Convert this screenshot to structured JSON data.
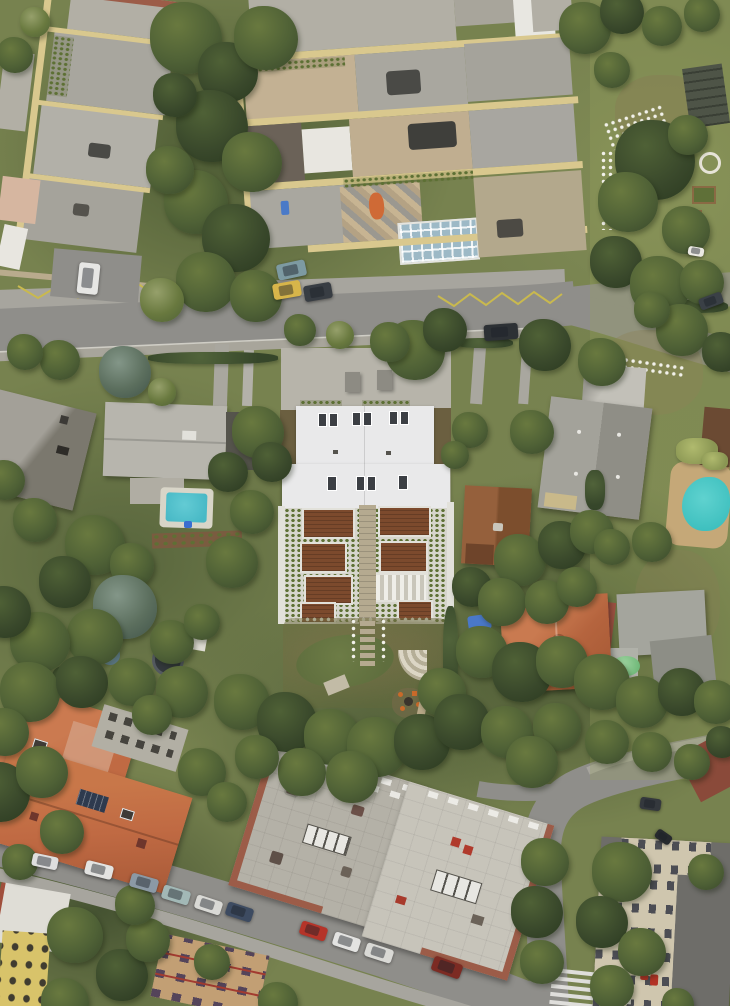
{
  "meta": {
    "type": "aerial-drone-photograph",
    "description": "Top-down drone photo of a residential neighborhood: a central white-standing-seam-roof terraced building with brown wooden deck terraces and a landscaped garden with oval lawn, surrounded by apartment blocks with roof terraces (top), family houses with pools (left and right), orange tiled roofs and flat-roofed apartment blocks (bottom), streets with parked cars, and dense trees."
  },
  "palette": {
    "grass": "#77824f",
    "grassDark": "#55633a",
    "grassLight": "#8d9663",
    "treeDark": "#39482b",
    "treeMid": "#4f6136",
    "treeLight": "#69793f",
    "treeBlue": "#5c6f5e",
    "asphalt": "#8f8e8a",
    "asphaltLight": "#a7a59e",
    "sidewalk": "#b0aea6",
    "yellowLine": "#c9b94e",
    "wallTan": "#b9ab8d",
    "whiteRoof": "#e9e9ea",
    "deckBrown": "#7c4a2d",
    "frameWhite": "#e2e1da",
    "stairBeige": "#b5aa90",
    "lawn": "#5f6e3e",
    "gardenSoil": "#75714b",
    "poolBlue": "#48b9c6",
    "poolRound": "#3fc0bf",
    "sandDeck": "#c5a878",
    "orangeRoof": "#c06a43",
    "orangeWorn": "#d29a7c",
    "tileRed": "#a04f3c",
    "greyRoof": "#b2afa5",
    "greyRoofDark": "#98968c",
    "metalRoof": "#b7b5ad",
    "cream": "#d9c88e",
    "yellowWall": "#d8c36a",
    "redBrick": "#9c5c48",
    "blockA": "#b4b1a7",
    "blockB": "#c7c4ba",
    "beigeWall": "#cfc6ae",
    "tanFacade": "#c29f74",
    "darkRoof": "#6e6d69",
    "cabinRust": "#8a5535",
    "ruinDark": "#4e5447",
    "conservGlass": "#9db9c6",
    "solarDark": "#2e3a4e",
    "orangeTent": "#cf6a36",
    "firePit": "#c96a2a"
  },
  "scene": {
    "landmarks": [
      "white-roof-terraced-building-center",
      "roof-terrace-apartments-top",
      "community-garden-right",
      "rectangular-pool-left-garden",
      "round-pool-right-garden",
      "rust-cabin",
      "orange-tile-roof-complex-bottom-left",
      "flat-roof-apartment-blocks-bottom-center",
      "beige-office-building-bottom-right",
      "oval-lawn-with-stepping-path",
      "fire-pit-with-orange-stools"
    ],
    "cars": [
      [
        78,
        263,
        21,
        31,
        6,
        "#e6e6e4"
      ],
      [
        277,
        262,
        29,
        16,
        -12,
        "#7d9aa2"
      ],
      [
        273,
        282,
        28,
        16,
        -10,
        "#d7b54a"
      ],
      [
        304,
        284,
        28,
        16,
        -10,
        "#383d43"
      ],
      [
        484,
        324,
        34,
        16,
        -4,
        "#2d3135"
      ],
      [
        699,
        295,
        24,
        12,
        -20,
        "#3a4046"
      ],
      [
        640,
        798,
        21,
        12,
        8,
        "#34383d"
      ],
      [
        655,
        832,
        17,
        10,
        35,
        "#26292d"
      ],
      [
        32,
        855,
        26,
        13,
        12,
        "#dedede"
      ],
      [
        85,
        863,
        28,
        14,
        14,
        "#e3e3e1"
      ],
      [
        130,
        876,
        28,
        14,
        16,
        "#8b99a5"
      ],
      [
        162,
        888,
        28,
        14,
        17,
        "#a2b8b6"
      ],
      [
        195,
        898,
        27,
        14,
        18,
        "#d9d9d5"
      ],
      [
        226,
        905,
        27,
        14,
        18,
        "#3d4b61"
      ],
      [
        300,
        924,
        27,
        14,
        18,
        "#b53429"
      ],
      [
        333,
        935,
        27,
        14,
        18,
        "#e3e3e1"
      ],
      [
        365,
        946,
        28,
        14,
        18,
        "#d9d9d5"
      ],
      [
        432,
        960,
        30,
        15,
        20,
        "#7c2b23"
      ],
      [
        688,
        247,
        16,
        9,
        10,
        "#ebe9e3"
      ]
    ],
    "trees": [
      [
        15,
        55,
        18,
        0
      ],
      [
        35,
        22,
        15,
        2
      ],
      [
        186,
        38,
        36,
        0
      ],
      [
        228,
        72,
        30,
        1
      ],
      [
        266,
        38,
        32,
        0
      ],
      [
        212,
        126,
        36,
        1
      ],
      [
        252,
        162,
        30,
        0
      ],
      [
        196,
        202,
        32,
        0
      ],
      [
        236,
        238,
        34,
        1
      ],
      [
        206,
        282,
        30,
        0
      ],
      [
        256,
        296,
        26,
        0
      ],
      [
        162,
        300,
        22,
        2
      ],
      [
        170,
        170,
        24,
        0
      ],
      [
        175,
        95,
        22,
        1
      ],
      [
        585,
        28,
        26,
        0
      ],
      [
        622,
        12,
        22,
        1
      ],
      [
        662,
        26,
        20,
        0
      ],
      [
        702,
        14,
        18,
        0
      ],
      [
        612,
        70,
        18,
        0
      ],
      [
        655,
        160,
        40,
        1
      ],
      [
        628,
        202,
        30,
        0
      ],
      [
        686,
        230,
        24,
        0
      ],
      [
        616,
        262,
        26,
        1
      ],
      [
        660,
        286,
        30,
        0
      ],
      [
        702,
        282,
        22,
        0
      ],
      [
        688,
        135,
        20,
        0
      ],
      [
        415,
        350,
        30,
        0
      ],
      [
        445,
        330,
        22,
        1
      ],
      [
        390,
        342,
        20,
        0
      ],
      [
        545,
        345,
        26,
        1
      ],
      [
        602,
        362,
        24,
        0
      ],
      [
        682,
        330,
        26,
        0
      ],
      [
        722,
        352,
        20,
        1
      ],
      [
        652,
        310,
        18,
        0
      ],
      [
        125,
        372,
        26,
        3
      ],
      [
        60,
        360,
        20,
        0
      ],
      [
        25,
        352,
        18,
        0
      ],
      [
        162,
        392,
        14,
        2
      ],
      [
        300,
        330,
        16,
        0
      ],
      [
        340,
        335,
        14,
        2
      ],
      [
        258,
        432,
        26,
        0
      ],
      [
        272,
        462,
        20,
        1
      ],
      [
        95,
        545,
        30,
        0
      ],
      [
        65,
        582,
        26,
        1
      ],
      [
        132,
        565,
        22,
        0
      ],
      [
        35,
        520,
        22,
        0
      ],
      [
        5,
        480,
        20,
        0
      ],
      [
        125,
        607,
        32,
        3
      ],
      [
        95,
        637,
        28,
        0
      ],
      [
        40,
        642,
        30,
        0
      ],
      [
        5,
        612,
        26,
        1
      ],
      [
        172,
        642,
        22,
        0
      ],
      [
        202,
        622,
        18,
        0
      ],
      [
        232,
        562,
        26,
        0
      ],
      [
        252,
        512,
        22,
        0
      ],
      [
        228,
        472,
        20,
        1
      ],
      [
        30,
        692,
        30,
        0
      ],
      [
        82,
        682,
        26,
        1
      ],
      [
        132,
        682,
        24,
        0
      ],
      [
        182,
        692,
        26,
        0
      ],
      [
        5,
        732,
        24,
        0
      ],
      [
        152,
        715,
        20,
        0
      ],
      [
        242,
        702,
        28,
        0
      ],
      [
        287,
        722,
        30,
        1
      ],
      [
        332,
        737,
        28,
        0
      ],
      [
        377,
        747,
        30,
        0
      ],
      [
        422,
        742,
        28,
        1
      ],
      [
        302,
        772,
        24,
        0
      ],
      [
        352,
        777,
        26,
        0
      ],
      [
        257,
        757,
        22,
        0
      ],
      [
        532,
        432,
        22,
        0
      ],
      [
        470,
        430,
        18,
        0
      ],
      [
        455,
        455,
        14,
        0
      ],
      [
        520,
        560,
        26,
        0
      ],
      [
        562,
        545,
        24,
        1
      ],
      [
        592,
        532,
        22,
        0
      ],
      [
        472,
        587,
        20,
        1
      ],
      [
        502,
        602,
        24,
        0
      ],
      [
        547,
        602,
        22,
        0
      ],
      [
        577,
        587,
        20,
        0
      ],
      [
        612,
        547,
        18,
        0
      ],
      [
        652,
        542,
        20,
        0
      ],
      [
        482,
        652,
        26,
        0
      ],
      [
        522,
        672,
        30,
        1
      ],
      [
        562,
        662,
        26,
        0
      ],
      [
        602,
        682,
        28,
        0
      ],
      [
        642,
        702,
        26,
        0
      ],
      [
        682,
        692,
        24,
        1
      ],
      [
        716,
        702,
        22,
        0
      ],
      [
        442,
        692,
        24,
        0
      ],
      [
        462,
        722,
        28,
        1
      ],
      [
        507,
        732,
        26,
        0
      ],
      [
        557,
        727,
        24,
        0
      ],
      [
        607,
        742,
        22,
        0
      ],
      [
        652,
        752,
        20,
        0
      ],
      [
        692,
        762,
        18,
        0
      ],
      [
        722,
        742,
        16,
        1
      ],
      [
        0,
        792,
        30,
        1
      ],
      [
        42,
        772,
        26,
        0
      ],
      [
        202,
        772,
        24,
        0
      ],
      [
        227,
        802,
        20,
        0
      ],
      [
        62,
        832,
        22,
        0
      ],
      [
        20,
        862,
        18,
        0
      ],
      [
        75,
        935,
        28,
        0
      ],
      [
        122,
        975,
        26,
        1
      ],
      [
        148,
        940,
        22,
        0
      ],
      [
        65,
        1002,
        24,
        0
      ],
      [
        135,
        905,
        20,
        0
      ],
      [
        278,
        1002,
        20,
        0
      ],
      [
        212,
        962,
        18,
        0
      ],
      [
        532,
        762,
        26,
        0
      ],
      [
        545,
        862,
        24,
        0
      ],
      [
        537,
        912,
        26,
        1
      ],
      [
        542,
        962,
        22,
        0
      ],
      [
        622,
        872,
        30,
        0
      ],
      [
        602,
        922,
        26,
        1
      ],
      [
        642,
        952,
        24,
        0
      ],
      [
        612,
        987,
        22,
        0
      ],
      [
        706,
        872,
        18,
        0
      ],
      [
        678,
        1004,
        16,
        0
      ]
    ],
    "bushes": [
      [
        443,
        606,
        15,
        98,
        0
      ],
      [
        52,
        666,
        28,
        26,
        0
      ],
      [
        148,
        352,
        130,
        12,
        0
      ],
      [
        455,
        338,
        58,
        10,
        0
      ],
      [
        676,
        438,
        42,
        26,
        1
      ],
      [
        702,
        452,
        26,
        18,
        1
      ],
      [
        585,
        470,
        20,
        40,
        0
      ],
      [
        662,
        300,
        66,
        13,
        0
      ]
    ]
  }
}
